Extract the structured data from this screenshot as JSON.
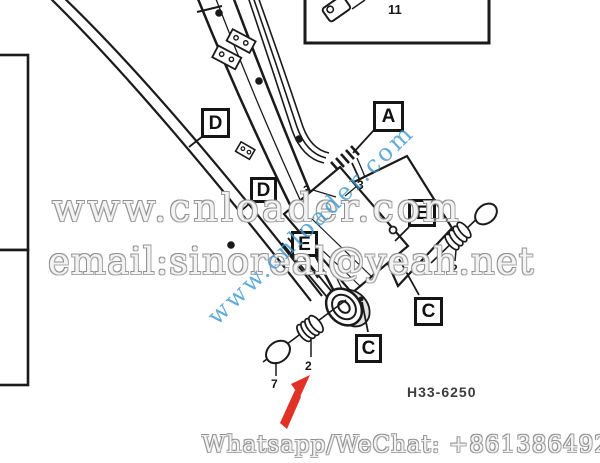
{
  "drawing": {
    "number": "H33-6250",
    "callouts": [
      {
        "id": "D-upper",
        "label": "D"
      },
      {
        "id": "D-lower",
        "label": "D"
      },
      {
        "id": "A",
        "label": "A"
      },
      {
        "id": "E-left",
        "label": "E"
      },
      {
        "id": "E-right",
        "label": "E"
      },
      {
        "id": "C-lower",
        "label": "C"
      },
      {
        "id": "C-upper",
        "label": "C"
      }
    ],
    "part_numbers": [
      {
        "id": "shim-plate",
        "label": "11"
      },
      {
        "id": "hose-left",
        "label": "3"
      },
      {
        "id": "hose-right",
        "label": "3"
      },
      {
        "id": "bushing-right",
        "label": "2"
      },
      {
        "id": "bushing-bottom",
        "label": "2"
      },
      {
        "id": "washer-bottom",
        "label": "7"
      }
    ]
  },
  "watermarks": {
    "site_large": "www.cnloader.com",
    "email": "email:sinoreal@yeah.net",
    "diagonal_site": "www.cnloader.com",
    "contact": "Whatsapp/WeChat: +8613864928019"
  },
  "colors": {
    "arrow_red": "#e03226",
    "watermark_blue": "#3e98cd",
    "watermark_gray": "#9c9c9c",
    "line_black": "#1a1a1a"
  }
}
